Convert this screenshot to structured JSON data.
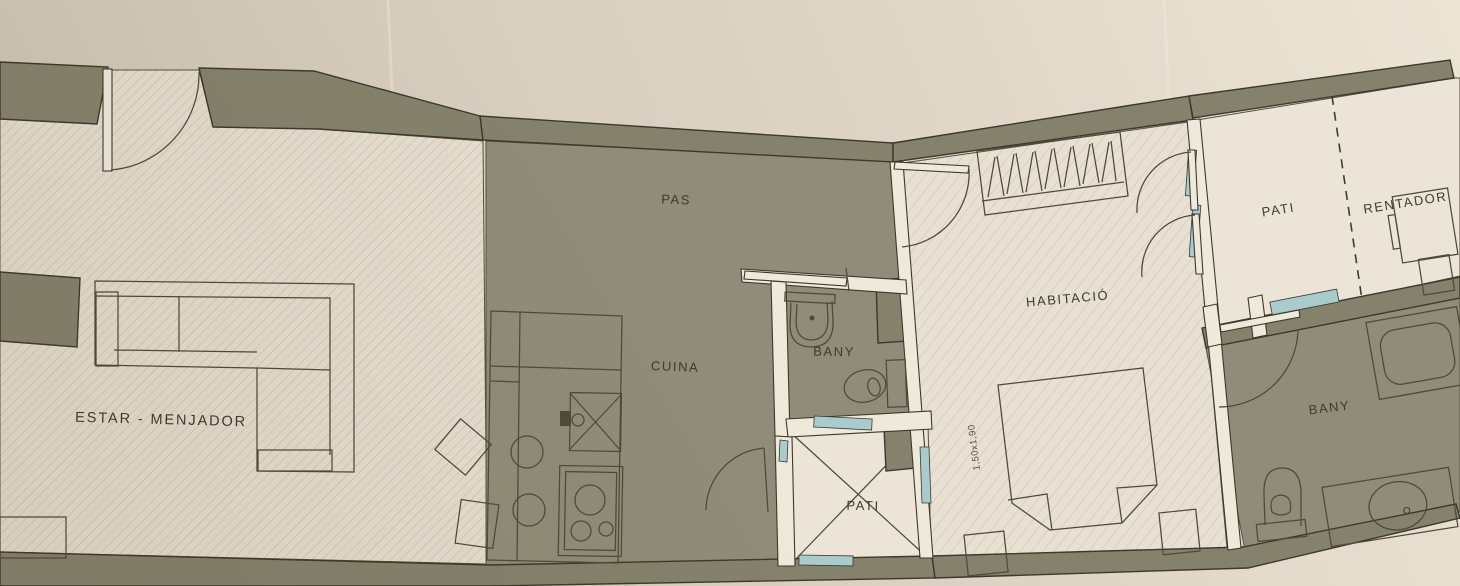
{
  "plan": {
    "labels": {
      "estar_menjador": "ESTAR - MENJADOR",
      "pas": "PAS",
      "cuina": "CUINA",
      "bany_center": "BANY",
      "pati_center": "PATI",
      "habitacio": "HABITACIÓ",
      "pati_right": "PATI",
      "rentador": "RENTADOR",
      "bany_right": "BANY",
      "bed_dimension": "1,50x1,90"
    },
    "colors": {
      "paper": "#d9cfc0",
      "wall": "#84816c",
      "floor_corridor": "#8f8c79",
      "floor_hatched": "#e5ddcf",
      "floor_patio": "#ece5d7",
      "partition": "#efe9db",
      "window_glass": "#a9cbce",
      "line": "#4f493a"
    }
  }
}
